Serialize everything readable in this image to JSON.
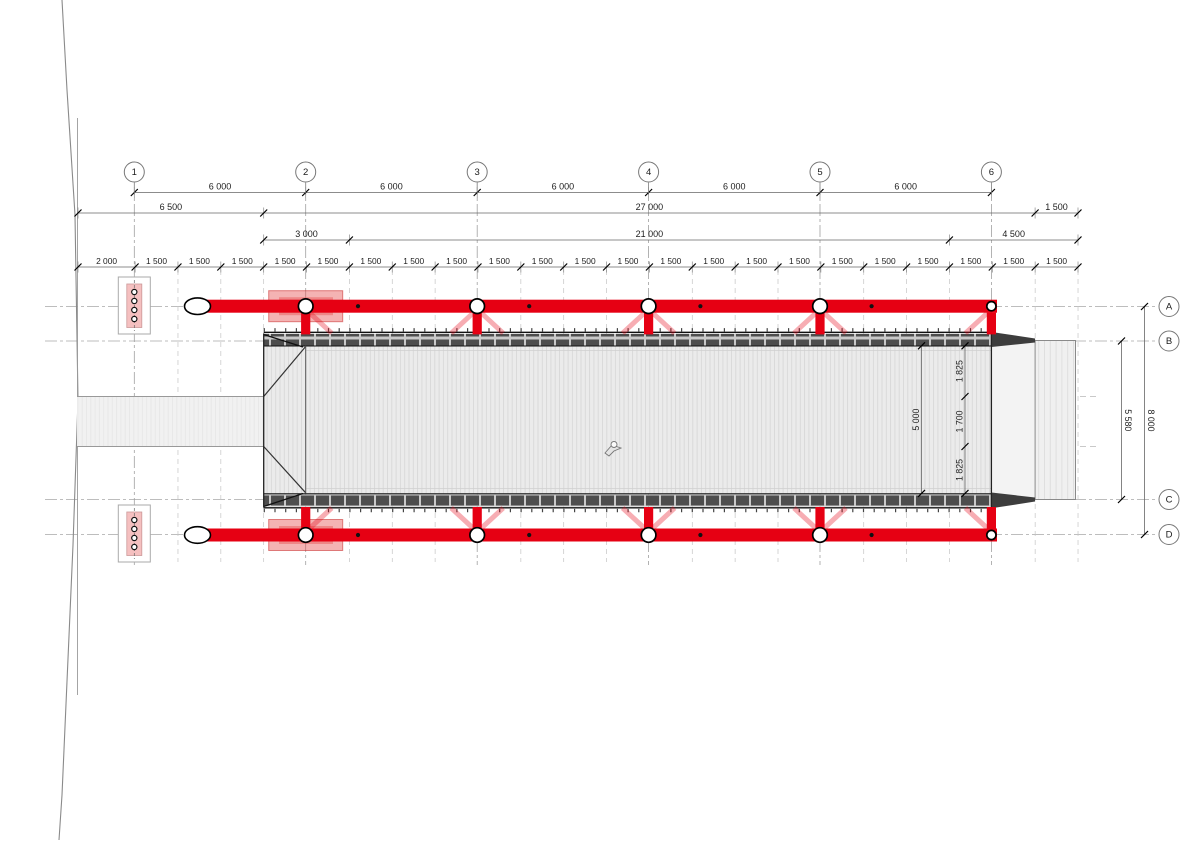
{
  "drawing_type": "bridge-plan",
  "grid": {
    "columns": [
      "1",
      "2",
      "3",
      "4",
      "5",
      "6"
    ],
    "rows": [
      "A",
      "B",
      "C",
      "D"
    ]
  },
  "dimensions": {
    "grid_spacing": [
      "6 000",
      "6 000",
      "6 000",
      "6 000",
      "6 000"
    ],
    "level2": [
      "6 500",
      "27 000",
      "1 500"
    ],
    "level3": [
      "3 000",
      "21 000",
      "4 500"
    ],
    "level4": [
      "2 000",
      "1 500",
      "1 500",
      "1 500",
      "1 500",
      "1 500",
      "1 500",
      "1 500",
      "1 500",
      "1 500",
      "1 500",
      "1 500",
      "1 500",
      "1 500",
      "1 500",
      "1 500",
      "1 500",
      "1 500",
      "1 500",
      "1 500",
      "1 500",
      "1 500",
      "1 500"
    ],
    "right_vertical": [
      "5 580",
      "8 000"
    ],
    "deck_chain": [
      "1 825",
      "1 700",
      "1 825"
    ],
    "deck_clear_width": "5 000"
  },
  "icons": {
    "person": "person-icon",
    "pier_anchor": "anchor-circles",
    "beam_end": "ellipse-cap"
  },
  "colors": {
    "structure_red": "#e60013",
    "brace_pink": "rgba(230,0,19,0.32)",
    "footprint_pink": "rgba(229,75,75,0.42)",
    "pier_pink": "#f5c0c0",
    "deck_fill": "#ebebeb",
    "deck_stripe": "#d8d8d8",
    "band_dark": "#4d4d4d",
    "landing_fill": "#f0f0f0",
    "dim_line": "#666666",
    "grid_line": "#999999"
  }
}
